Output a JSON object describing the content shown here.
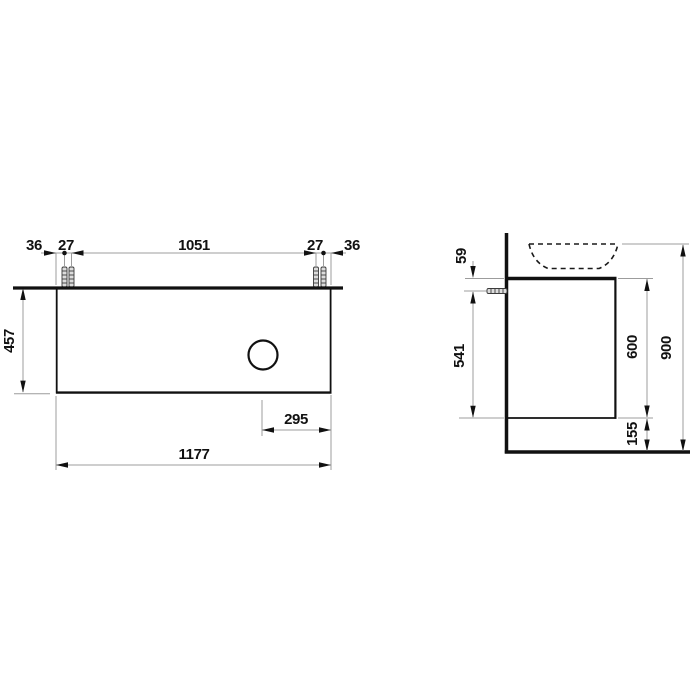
{
  "drawing": {
    "kind": "technical-dimension-drawing",
    "units": "mm",
    "colors": {
      "object_line": "#111111",
      "dimension_line": "#9c9c9c",
      "background": "#ffffff",
      "text": "#111111"
    },
    "front_view": {
      "top_chain": {
        "left_margin": "36",
        "left_gap": "27",
        "center_span": "1051",
        "right_gap": "27",
        "right_margin": "36"
      },
      "height": "457",
      "drain_to_edge": "295",
      "total_width": "1177"
    },
    "side_view": {
      "top_to_fixing": "59",
      "fixing_to_bottom": "541",
      "body_height": "600",
      "bottom_clearance": "155",
      "total_height": "900"
    }
  }
}
